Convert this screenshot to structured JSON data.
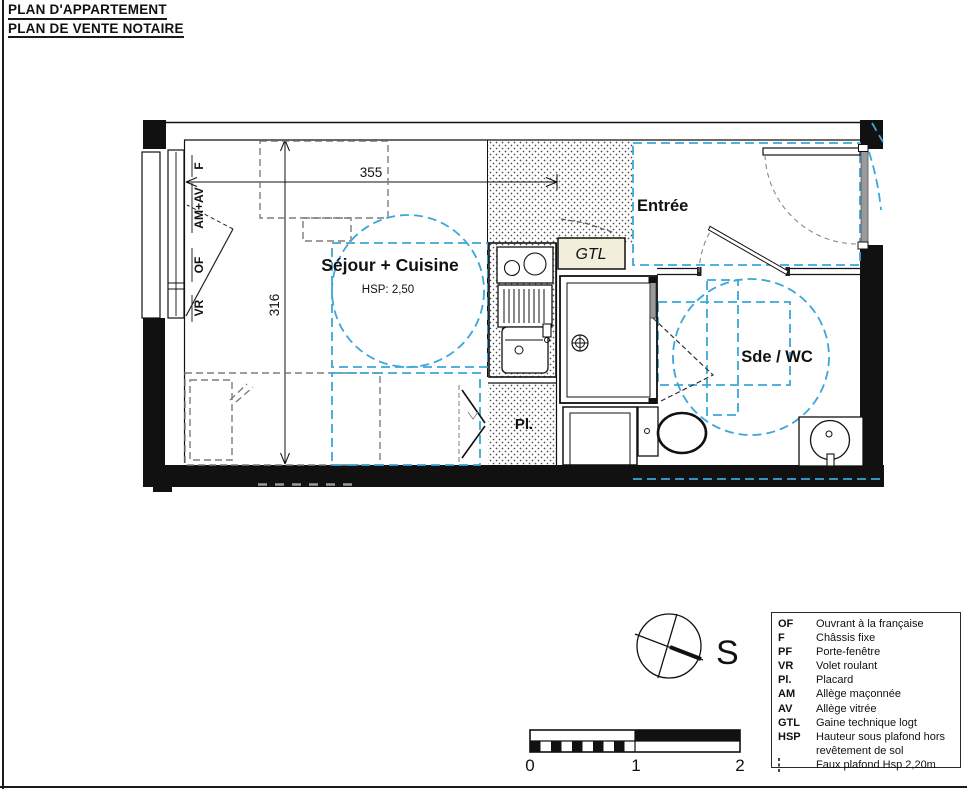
{
  "title": {
    "line1": "PLAN D'APPARTEMENT",
    "line2": "PLAN DE VENTE NOTAIRE"
  },
  "rooms": {
    "sejour": {
      "name": "Séjour + Cuisine",
      "hsp": "HSP: 2,50"
    },
    "entree": {
      "name": "Entrée"
    },
    "sde_wc": {
      "name": "Sde / WC"
    },
    "placard": {
      "name": "Pl."
    },
    "gtl": {
      "name": "GTL"
    }
  },
  "dimensions": {
    "width_cm": "355",
    "height_cm": "316"
  },
  "window_labels": {
    "f": "F",
    "am_av": "AM+AV",
    "of": "OF",
    "vr": "VR"
  },
  "compass": {
    "south_label": "S"
  },
  "scale_bar": {
    "tick0": "0",
    "tick1": "1",
    "tick2": "2"
  },
  "legend": {
    "items": [
      {
        "abbr": "OF",
        "label": "Ouvrant à la française"
      },
      {
        "abbr": "F",
        "label": "Châssis fixe"
      },
      {
        "abbr": "PF",
        "label": "Porte-fenêtre"
      },
      {
        "abbr": "VR",
        "label": "Volet roulant"
      },
      {
        "abbr": "Pl.",
        "label": "Placard"
      },
      {
        "abbr": "AM",
        "label": "Allège maçonnée"
      },
      {
        "abbr": "AV",
        "label": "Allège vitrée"
      },
      {
        "abbr": "GTL",
        "label": "Gaine technique logt"
      },
      {
        "abbr": "HSP",
        "label": "Hauteur sous plafond hors revêtement de sol"
      },
      {
        "abbr": "",
        "label": "Faux plafond Hsp 2,20m"
      }
    ]
  },
  "colors": {
    "accessibility_blue": "#3aa7d9",
    "furniture_gray": "#7d7d7d",
    "gtl_fill": "#f1eedb",
    "wall_black": "#111111"
  }
}
